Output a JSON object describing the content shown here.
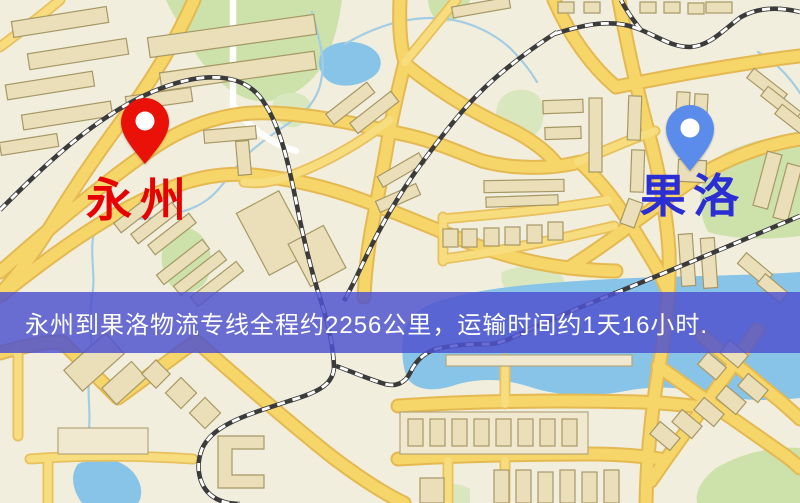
{
  "banner": {
    "text": "永州到果洛物流专线全程约2256公里，运输时间约1天16小时.",
    "background_color": "#4f52ce",
    "text_color": "#ffffff"
  },
  "markers": {
    "origin": {
      "label": "永州",
      "label_color": "#e60202",
      "pin_color": "#ea1208",
      "pin_icon": "red-map-pin"
    },
    "destination": {
      "label": "果洛",
      "label_color": "#2a2ed3",
      "pin_color": "#5c8ceb",
      "pin_icon": "blue-map-pin"
    }
  },
  "route_info": {
    "origin": "永州",
    "destination": "果洛",
    "service": "物流专线",
    "distance": "约2256公里",
    "duration": "约1天16小时"
  },
  "map_palette": {
    "land": "#f2eedd",
    "park": "#cde1ab",
    "water": "#88c4e8",
    "road_fill": "#f6d569",
    "road_casing": "#e4b952",
    "railway": "#3b3b3b",
    "building": "#ebdfb9"
  }
}
